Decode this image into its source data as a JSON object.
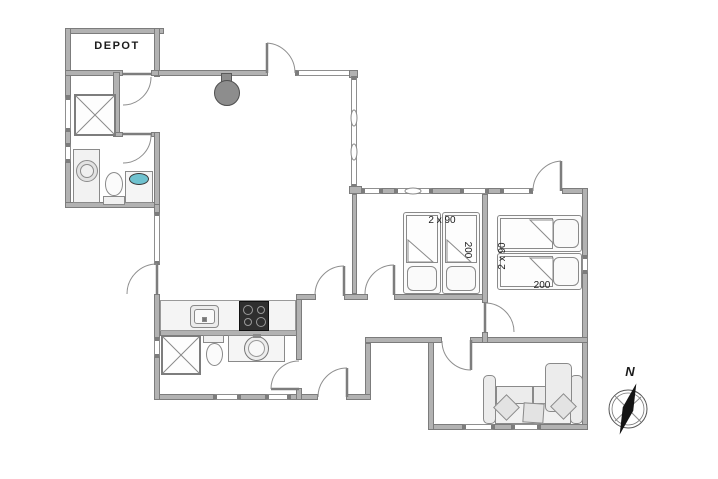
{
  "plan": {
    "depot_label": "DEPOT",
    "bedroom1": {
      "bed_width_label": "2 x 90",
      "bed_length_label": "200"
    },
    "bedroom2": {
      "bed_width_label": "2 x 90",
      "bed_length_label": "200"
    },
    "compass": {
      "north_label": "N"
    },
    "colors": {
      "wall_fill": "#b2b2b2",
      "wall_edge": "#7c7c7c",
      "fixture_line": "#8a8a8a",
      "cooktop": "#2f2f2f",
      "wood_stove": "#8d8d8d",
      "basin_accent": "#6fc2cf",
      "compass_needle": "#141414"
    }
  }
}
